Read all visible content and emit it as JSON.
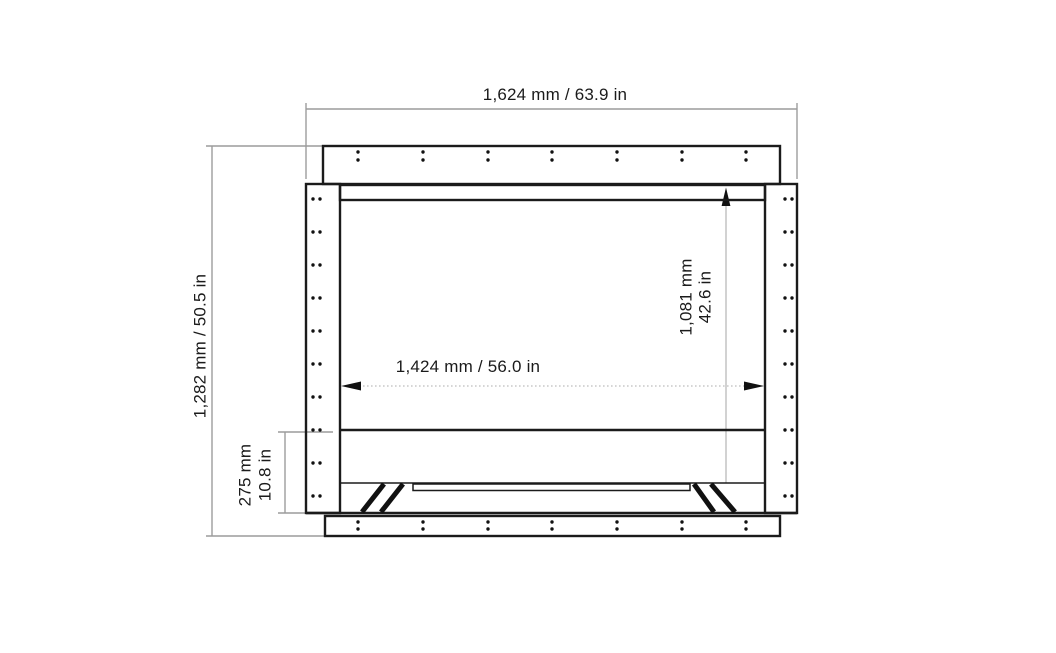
{
  "drawing": {
    "colors": {
      "line": "#1b1b1b",
      "dimension_line": "#9c9c9c",
      "background": "#ffffff"
    },
    "labels": {
      "overall_width": "1,624 mm / 63.9 in",
      "overall_height": "1,282 mm / 50.5 in",
      "interior_width": "1,424 mm / 56.0 in",
      "interior_height_mm": "1,081 mm",
      "interior_height_in": "42.6 in",
      "base_height_mm": "275 mm",
      "base_height_in": "10.8 in"
    },
    "values": {
      "overall_width_mm": 1624,
      "overall_width_in": 63.9,
      "overall_height_mm": 1282,
      "overall_height_in": 50.5,
      "interior_width_mm": 1424,
      "interior_width_in": 56.0,
      "interior_height_mm": 1081,
      "interior_height_in": 42.6,
      "base_height_mm": 275,
      "base_height_in": 10.8
    }
  }
}
